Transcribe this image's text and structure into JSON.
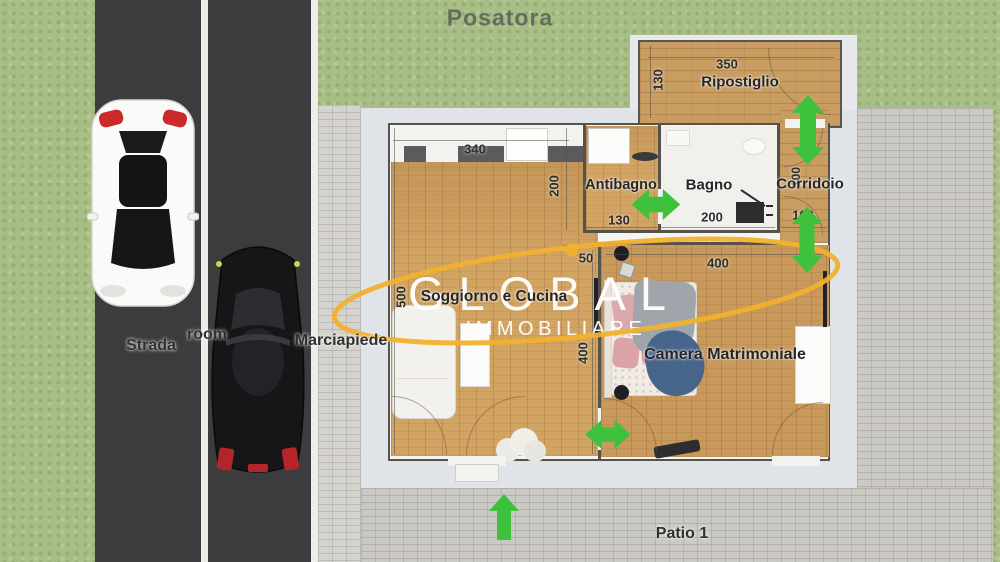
{
  "title": "Posatora",
  "watermark": {
    "brand": "GLOBAL",
    "sub": "IMMOBILIARE",
    "accent_color": "#F1B12E"
  },
  "outdoor": {
    "street_label": "Strada",
    "lane_label": "room",
    "sidewalk_label": "Marciapiede",
    "patio_label": "Patio 1"
  },
  "plan": {
    "ripostiglio": {
      "label": "Ripostiglio",
      "dim_width": "350",
      "dim_depth": "130"
    },
    "soggiorno": {
      "label": "Soggiorno e Cucina",
      "dim_top": "340",
      "dim_kitchen_depth": "200",
      "dim_left": "500",
      "dim_niche": "50",
      "dim_side": "400"
    },
    "antibagno": {
      "label": "Antibagno",
      "dim_width": "130"
    },
    "bagno": {
      "label": "Bagno",
      "dim_width": "200"
    },
    "corridoio": {
      "label": "Corridoio",
      "dim_width": "100",
      "dim_length": "100"
    },
    "camera": {
      "label": "Camera Matrimoniale",
      "dim_width": "400"
    }
  },
  "colors": {
    "arrow_green": "#3EC23E",
    "logo_yellow": "#F1B12E",
    "grass": "#A8BE87",
    "road": "#3C3C3E",
    "wood": "#D1A464",
    "brick": "#CBC9C4",
    "slab": "#E0E4E9"
  }
}
